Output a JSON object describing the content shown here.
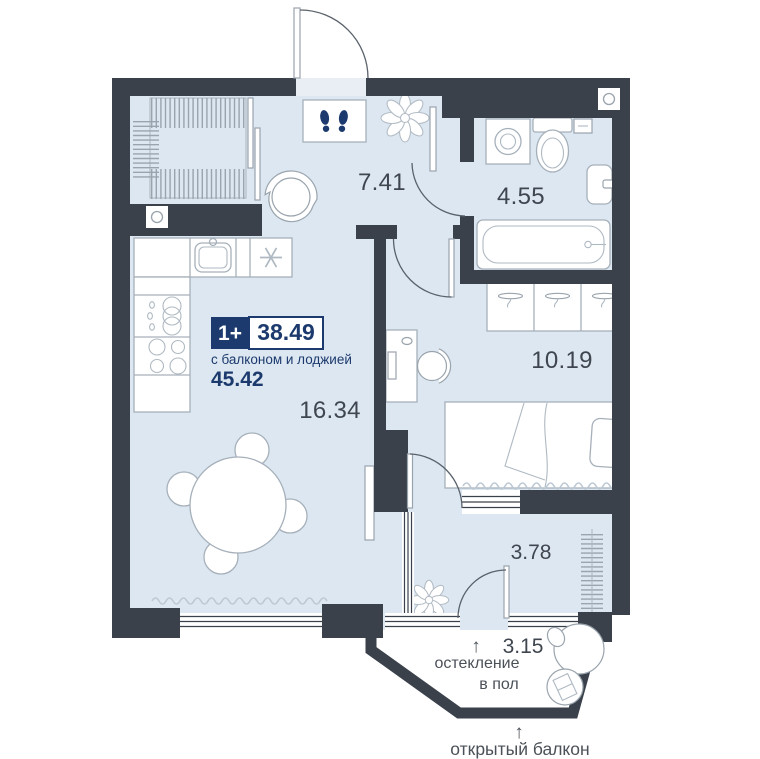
{
  "badge": {
    "rooms": "1+",
    "area": "38.49",
    "subtitle": "с балконом и лоджией",
    "area_total": "45.42"
  },
  "rooms": {
    "hallway": {
      "area": "7.41"
    },
    "bathroom": {
      "area": "4.55"
    },
    "bedroom": {
      "area": "10.19"
    },
    "living_kitchen": {
      "area": "16.34"
    },
    "loggia": {
      "area": "3.78"
    },
    "balcony": {
      "area": "3.15"
    }
  },
  "annotations": {
    "arrow_up": "↑",
    "glazing_line1": "остекление",
    "glazing_line2": "в пол",
    "open_balcony": "открытый балкон"
  },
  "icons": [
    "footprints-icon",
    "plant-icon",
    "snowflake-icon",
    "sink-icon",
    "stove-icon",
    "dish-rack-icon",
    "washing-machine-icon",
    "toilet-icon",
    "bathtub-icon",
    "boiler-icon",
    "hanger-icon",
    "monitor-icon",
    "vent-icon",
    "hanging-chair-icon",
    "drying-rack-icon"
  ],
  "colors": {
    "wall": "#3A414B",
    "floor": "#DCE7F1",
    "accent_navy": "#1C3A6D",
    "outline": "#A6B0BA",
    "room_text": "#3F464F",
    "note_text": "#4B5158"
  }
}
